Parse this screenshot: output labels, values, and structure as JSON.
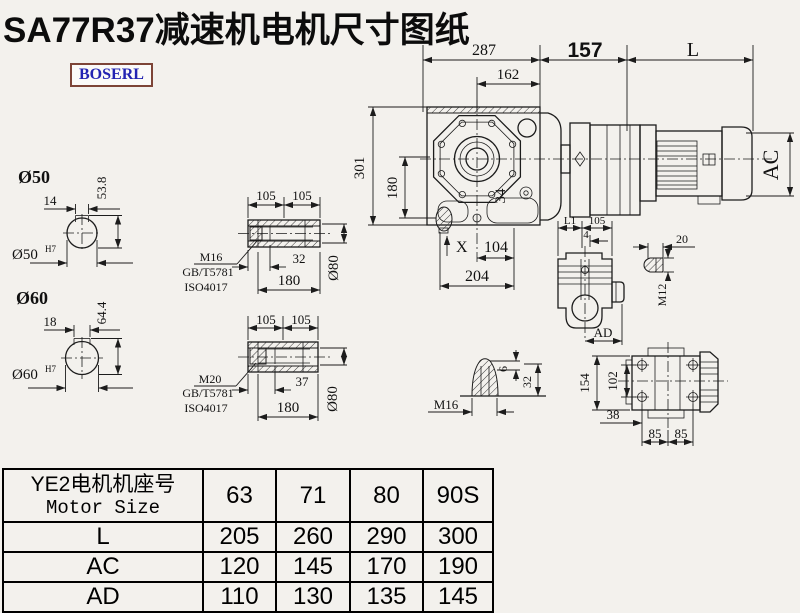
{
  "title": "SA77R37减速机电机尺寸图纸",
  "logo": {
    "text": "BOSERL"
  },
  "colors": {
    "background": "#f3f1ed",
    "line": "#1c1c1c",
    "logo_text": "#2323b2",
    "logo_border": "#7d4437"
  },
  "main_view": {
    "d287": "287",
    "d162": "162",
    "d157": "157",
    "dL": "L",
    "d301": "301",
    "d180": "180",
    "d34": "34",
    "dX": "X",
    "d104": "104",
    "d204": "204",
    "dAC": "AC"
  },
  "shaft_50": {
    "label": "Ø50",
    "keyway_width": "14",
    "total_height": "53.8",
    "bore": "Ø50",
    "bore_tol": "H7"
  },
  "shaft_60": {
    "label": "Ø60",
    "keyway_width": "18",
    "total_height": "64.4",
    "bore": "Ø60",
    "bore_tol": "H7"
  },
  "hollow_shaft_16": {
    "d105_left": "105",
    "d105_right": "105",
    "depth": "32",
    "length": "180",
    "outer": "Ø80",
    "bolt": "M16",
    "std1": "GB/T5781",
    "std2": "ISO4017"
  },
  "hollow_shaft_20": {
    "d105_left": "105",
    "d105_right": "105",
    "depth": "37",
    "length": "180",
    "outer": "Ø80",
    "bolt": "M20",
    "std1": "GB/T5781",
    "std2": "ISO4017"
  },
  "cone_plug": {
    "d6": "6",
    "d32": "32",
    "thread": "M16"
  },
  "side_view": {
    "dL1": "L1",
    "d105": "105",
    "d4": "4",
    "dAD": "AD"
  },
  "plug_m12": {
    "d20": "20",
    "thread": "M12"
  },
  "bottom_view": {
    "d154": "154",
    "d102": "102",
    "d38": "38",
    "d85_left": "85",
    "d85_right": "85"
  },
  "table": {
    "header": {
      "line1": "YE2电机机座号",
      "line2": "Motor Size"
    },
    "columns": [
      "63",
      "71",
      "80",
      "90S"
    ],
    "rows": [
      {
        "label": "L",
        "values": [
          "205",
          "260",
          "290",
          "300"
        ]
      },
      {
        "label": "AC",
        "values": [
          "120",
          "145",
          "170",
          "190"
        ]
      },
      {
        "label": "AD",
        "values": [
          "110",
          "130",
          "135",
          "145"
        ]
      }
    ]
  }
}
